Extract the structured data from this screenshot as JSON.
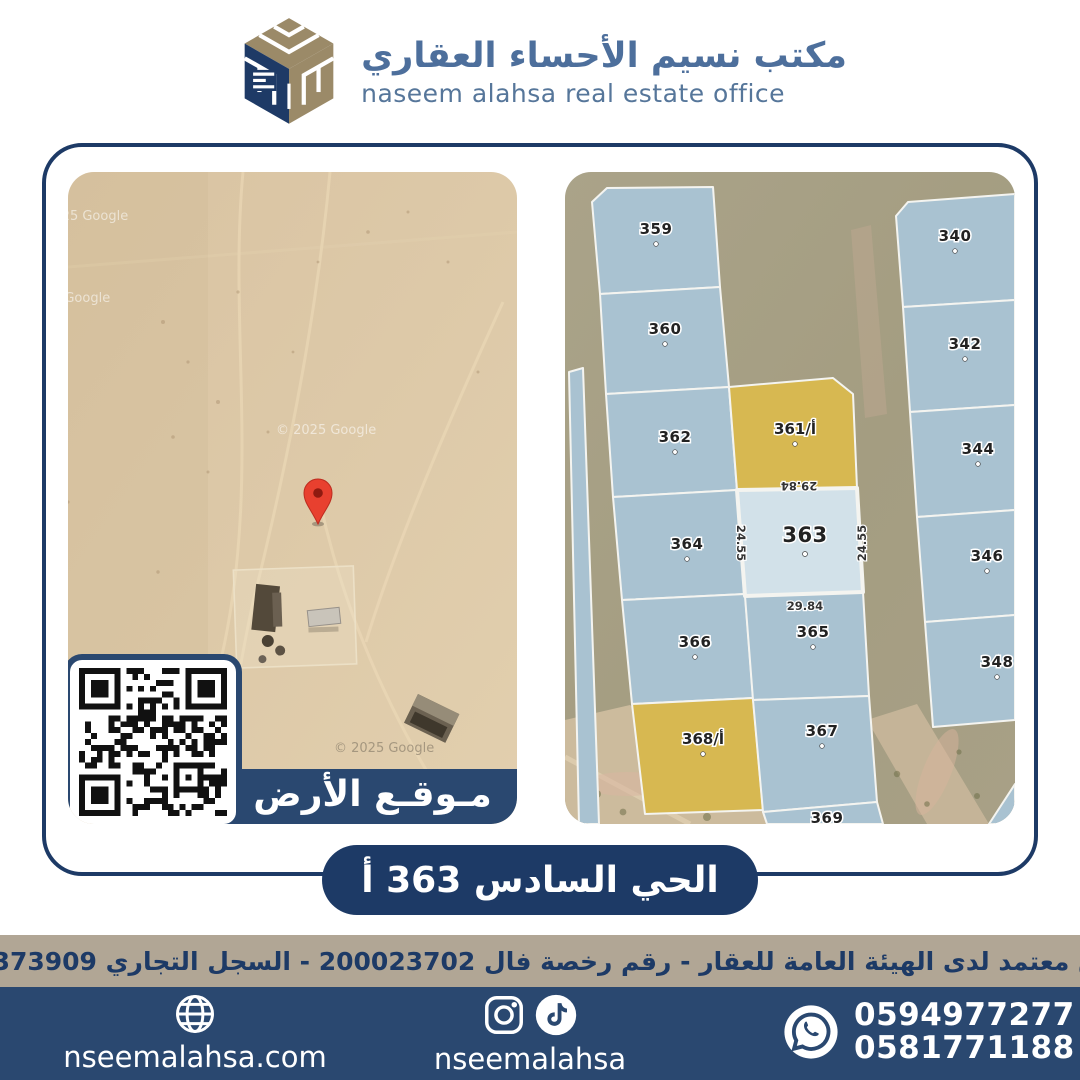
{
  "header": {
    "title_ar": "مكتب نسيم الأحساء العقاري",
    "title_en": "naseem alahsa real estate office"
  },
  "left_map": {
    "label": "مـوقـع الأرض",
    "watermark": "© 2025 Google"
  },
  "right_map": {
    "plots": [
      {
        "label": "359"
      },
      {
        "label": "360"
      },
      {
        "label": "362"
      },
      {
        "label": "364"
      },
      {
        "label": "366"
      },
      {
        "label": "أ/361"
      },
      {
        "label": "363"
      },
      {
        "label": "365"
      },
      {
        "label": "367"
      },
      {
        "label": "أ/368"
      },
      {
        "label": "369"
      },
      {
        "label": "340"
      },
      {
        "label": "342"
      },
      {
        "label": "344"
      },
      {
        "label": "346"
      },
      {
        "label": "348"
      }
    ],
    "highlight_plot": "363",
    "dims": {
      "top": "29.84",
      "bottom": "29.84",
      "left": "24.55",
      "right": "24.55"
    }
  },
  "banner": {
    "text": "الحي السادس 363 أ"
  },
  "license_bar": {
    "text": "مسوق معتمد لدى الهيئة العامة للعقار - رقم رخصة فال 200023702 - السجل التجاري 2250373909"
  },
  "footer": {
    "website": "nseemalahsa.com",
    "social": "nseemalahsa",
    "phones": [
      "0594977277",
      "0581771188"
    ]
  },
  "colors": {
    "navy_dark": "#1d3a66",
    "navy_mid": "#2a4870",
    "tan_strip": "#b1a695",
    "plot_blue": "#a9c2d1",
    "plot_yellow": "#d7b851",
    "plot_highlight": "#d2e1e9",
    "pin_red": "#e8402f",
    "logo_tan": "#9b8a68"
  }
}
